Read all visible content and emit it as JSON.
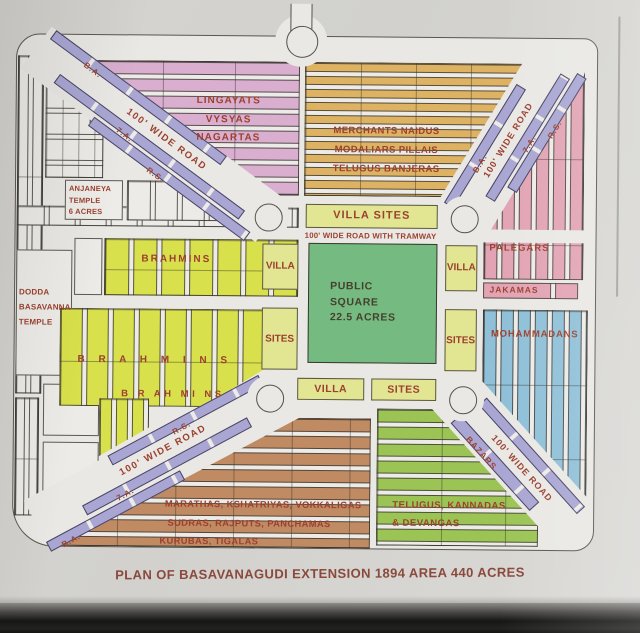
{
  "photo": {
    "caption": "PLAN OF BASAVANAGUDI EXTENSION 1894 AREA 440 ACRES"
  },
  "map": {
    "center": {
      "square_line1": "PUBLIC",
      "square_line2": "SQUARE",
      "square_line3": "22.5 ACRES",
      "villa_sites": "VILLA SITES",
      "tramway_road": "100' WIDE ROAD WITH TRAMWAY",
      "villa": "VILLA",
      "sites": "SITES"
    },
    "regions": {
      "lingayats": {
        "line1": "LINGAYATS",
        "line2": "VYSYAS",
        "line3": "NAGARTAS",
        "color": "#d9aecf"
      },
      "merchants": {
        "line1": "MERCHANTS NAIDUS",
        "line2": "MODALIARS PILLAIS",
        "line3": "TELUGUS BANJERAS",
        "color": "#ddb262"
      },
      "palegars": {
        "label": "PALEGARS",
        "color": "#e2a4b4"
      },
      "jakamas": {
        "label": "JAKAMAS",
        "color": "#e2a4b4"
      },
      "mohammadans": {
        "label": "MOHAMMADANS",
        "color": "#8fc0d8"
      },
      "brahmins_upper": {
        "label": "BRAHMINS",
        "color": "#d8e04b"
      },
      "brahmins_mid": {
        "label": "B R A H M I N S"
      },
      "brahmins_lower": {
        "label": "B R AH MI NS"
      },
      "marathas": {
        "line1": "MARATHAS, KSHATRIYAS, VOKKALIGAS",
        "line2": "SUDRAS, RAJPUTS, PANCHAMAS",
        "line3": "KURUBAS, TIGALAS",
        "color": "#c08a62"
      },
      "telugus": {
        "line1": "TELUGUS, KANNADAS",
        "line2": "& DEVANGAS",
        "color": "#9cc455"
      },
      "anjaneya_temple": {
        "line1": "ANJANEYA",
        "line2": "TEMPLE",
        "line3": "6 ACRES"
      },
      "dodda_temple": {
        "line1": "DODDA",
        "line2": "BASAVANNA",
        "line3": "TEMPLE"
      }
    },
    "roads": {
      "wide_road": "100' WIDE ROAD",
      "strip_ba": "B.A.",
      "strip_7a": "7.A.",
      "strip_rs": "R.S.",
      "strip_bazars": "BAZARS"
    },
    "colors": {
      "road_strip": "#a9a6d3",
      "public_square": "#74ba81",
      "villa_blocks": "#e2e592",
      "label_red": "#9c4130",
      "paper": "#e9e8e4"
    }
  }
}
